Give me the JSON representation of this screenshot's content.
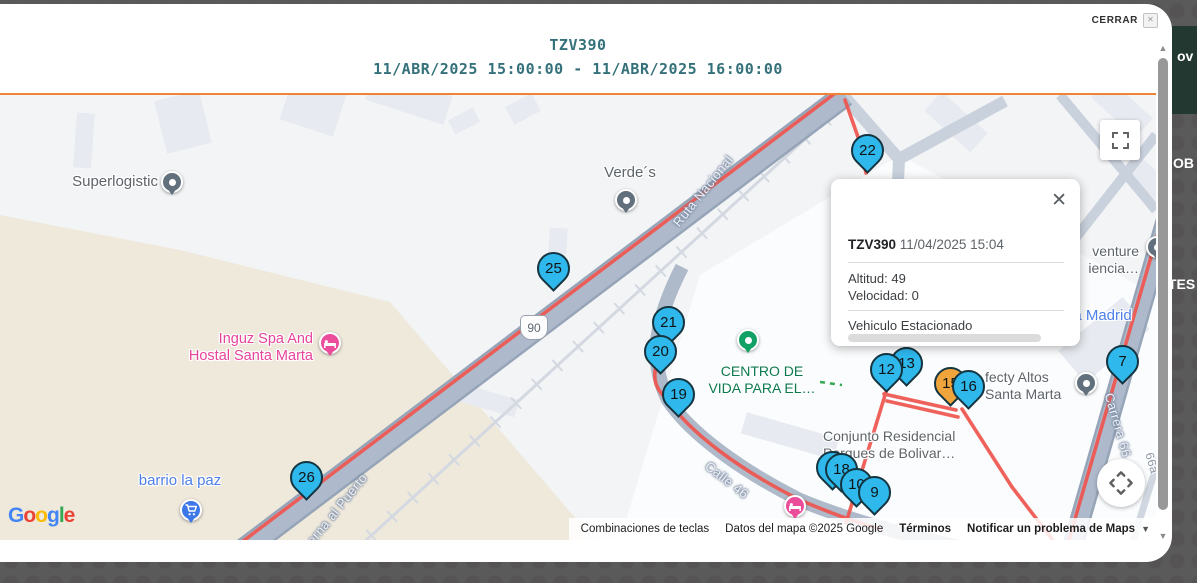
{
  "window": {
    "close_label": "CERRAR"
  },
  "header": {
    "vehicle_id": "TZV390",
    "date_range": "11/ABR/2025 15:00:00 - 11/ABR/2025 16:00:00"
  },
  "info_window": {
    "title": "TZV390",
    "timestamp": "11/04/2025 15:04",
    "altitude": "Altitud: 49",
    "speed": "Velocidad: 0",
    "status": "Vehiculo Estacionado"
  },
  "colors": {
    "accent_teal": "#35717a",
    "divider_orange": "#ee8434",
    "marker_blue": "#2eb8ec",
    "marker_orange": "#f0a43c",
    "route_red": "#ef554e"
  },
  "map": {
    "route_shield": "90",
    "markers": [
      {
        "label": "22",
        "color": "blue",
        "x": 867,
        "y": 55
      },
      {
        "label": "25",
        "color": "blue",
        "x": 553,
        "y": 173
      },
      {
        "label": "21",
        "color": "blue",
        "x": 668,
        "y": 227
      },
      {
        "label": "20",
        "color": "blue",
        "x": 660,
        "y": 256
      },
      {
        "label": "19",
        "color": "blue",
        "x": 678,
        "y": 299
      },
      {
        "label": "26",
        "color": "blue",
        "x": 306,
        "y": 382
      },
      {
        "label": "13",
        "color": "blue",
        "x": 906,
        "y": 268
      },
      {
        "label": "12",
        "color": "blue",
        "x": 886,
        "y": 274
      },
      {
        "label": "15",
        "color": "orange",
        "x": 950,
        "y": 288
      },
      {
        "label": "16",
        "color": "blue",
        "x": 968,
        "y": 291
      },
      {
        "label": "7",
        "color": "blue",
        "x": 1122,
        "y": 266
      },
      {
        "label": "11",
        "color": "blue",
        "x": 832,
        "y": 372
      },
      {
        "label": "18",
        "color": "blue",
        "x": 841,
        "y": 374
      },
      {
        "label": "10",
        "color": "blue",
        "x": 856,
        "y": 389
      },
      {
        "label": "9",
        "color": "blue",
        "x": 874,
        "y": 397
      }
    ],
    "pois": [
      {
        "id": "superlogistic",
        "type": "dot",
        "color": "#61707c",
        "x": 172,
        "y": 87,
        "label": {
          "lines": [
            "Superlogistic"
          ],
          "color": "#5d646b",
          "size": 15,
          "align": "right",
          "x": 158,
          "y": 79
        }
      },
      {
        "id": "verdes",
        "type": "dot",
        "color": "#61707c",
        "x": 626,
        "y": 105,
        "label": {
          "lines": [
            "Verde´s"
          ],
          "color": "#5d646b",
          "size": 15,
          "align": "center",
          "x": 630,
          "y": 70
        }
      },
      {
        "id": "inguz-spa",
        "type": "bed",
        "color": "#ec4d9b",
        "x": 330,
        "y": 248,
        "label": {
          "lines": [
            "Inguz Spa And",
            "Hostal Santa Marta"
          ],
          "color": "#e8439b",
          "size": 14.5,
          "align": "right",
          "x": 313,
          "y": 236
        }
      },
      {
        "id": "barrio-la-paz",
        "type": "cart",
        "color": "#3c78e7",
        "x": 191,
        "y": 415,
        "label": {
          "lines": [
            "barrio la paz"
          ],
          "color": "#4d7fe8",
          "size": 15,
          "align": "center",
          "x": 180,
          "y": 378
        }
      },
      {
        "id": "centro-de-vida",
        "type": "dot",
        "color": "#12a165",
        "x": 748,
        "y": 245,
        "label": {
          "lines": [
            "CENTRO DE",
            "VIDA PARA EL…"
          ],
          "color": "#0d7a4e",
          "size": 14,
          "align": "center",
          "x": 762,
          "y": 268
        }
      },
      {
        "id": "conjunto-residencial",
        "type": "none",
        "x": 0,
        "y": 0,
        "label": {
          "lines": [
            "Conjunto Residencial",
            "Parques de Bolivar…"
          ],
          "color": "#5f666b",
          "size": 14,
          "align": "left",
          "x": 823,
          "y": 333
        }
      },
      {
        "id": "fecty-altos",
        "type": "dot",
        "color": "#61707c",
        "x": 1086,
        "y": 288,
        "label": {
          "lines": [
            "fecty Altos",
            "Santa Marta"
          ],
          "color": "#5d646b",
          "size": 14,
          "align": "left",
          "x": 985,
          "y": 274
        }
      },
      {
        "id": "venture-experiencia",
        "type": "dot",
        "color": "#61707c",
        "x": 1157,
        "y": 152,
        "label": {
          "lines": [
            "venture",
            "iencia…"
          ],
          "color": "#5d646b",
          "size": 14,
          "align": "right",
          "x": 1139,
          "y": 148
        }
      },
      {
        "id": "via-madrid",
        "type": "none",
        "x": 0,
        "y": 0,
        "label": {
          "lines": [
            "ia Madrid"
          ],
          "color": "#4d7fe8",
          "size": 15,
          "align": "left",
          "x": 1070,
          "y": 213
        }
      },
      {
        "id": "hotel-pink",
        "type": "bed",
        "color": "#ec4d9b",
        "x": 795,
        "y": 411,
        "label": {
          "lines": [],
          "color": "#e8439b",
          "size": 13,
          "align": "left",
          "x": 0,
          "y": 0
        }
      }
    ],
    "road_labels": [
      {
        "text": "Ruta Nacional",
        "x": 703,
        "y": 96,
        "rot": -51,
        "minor": false
      },
      {
        "text": "erna al Puerto",
        "x": 337,
        "y": 414,
        "rot": -51,
        "minor": false
      },
      {
        "text": "Calle 46",
        "x": 727,
        "y": 385,
        "rot": 38,
        "minor": false
      },
      {
        "text": "Carrera 66",
        "x": 1118,
        "y": 330,
        "rot": 74,
        "minor": false
      },
      {
        "text": "66a",
        "x": 1152,
        "y": 368,
        "rot": 74,
        "minor": true
      }
    ],
    "attribution": {
      "keyboard": "Combinaciones de teclas",
      "map_data": "Datos del mapa ©2025 Google",
      "terms": "Términos",
      "report": "Notificar un problema de Maps"
    },
    "logo_letters": [
      {
        "ch": "G",
        "c": "#4285F4"
      },
      {
        "ch": "o",
        "c": "#EA4335"
      },
      {
        "ch": "o",
        "c": "#FBBC05"
      },
      {
        "ch": "g",
        "c": "#4285F4"
      },
      {
        "ch": "l",
        "c": "#34A853"
      },
      {
        "ch": "e",
        "c": "#EA4335"
      }
    ]
  },
  "background": {
    "fragments": [
      {
        "text": "ov",
        "x": 1177,
        "y": 48
      },
      {
        "text": "OB",
        "x": 1173,
        "y": 155
      },
      {
        "text": "TES",
        "x": 1168,
        "y": 276
      }
    ]
  }
}
